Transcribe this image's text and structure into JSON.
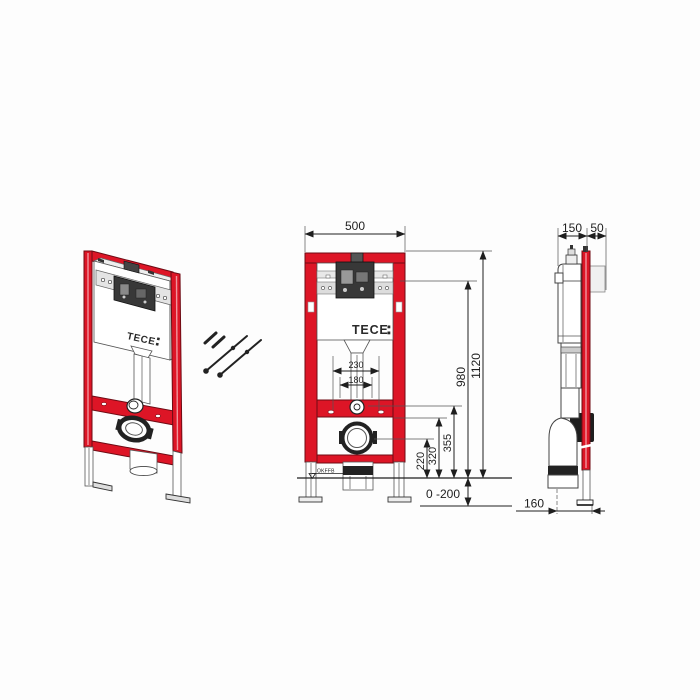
{
  "brand": {
    "logo_text": "TECE"
  },
  "front_view": {
    "dim_width": "500",
    "dim_height_total": "1120",
    "dim_height_cistern": "980",
    "dim_h355": "355",
    "dim_h320": "320",
    "dim_h220": "220",
    "dim_foot_range": "0 -200",
    "dim_span_outer": "230",
    "dim_span_inner": "180",
    "floor_label": "OKFFB"
  },
  "side_view": {
    "dim_depth_frame": "150",
    "dim_depth_front": "50",
    "dim_drain_offset": "160"
  },
  "colors": {
    "frame_red": "#dd1526",
    "line": "#1e1e1e"
  }
}
